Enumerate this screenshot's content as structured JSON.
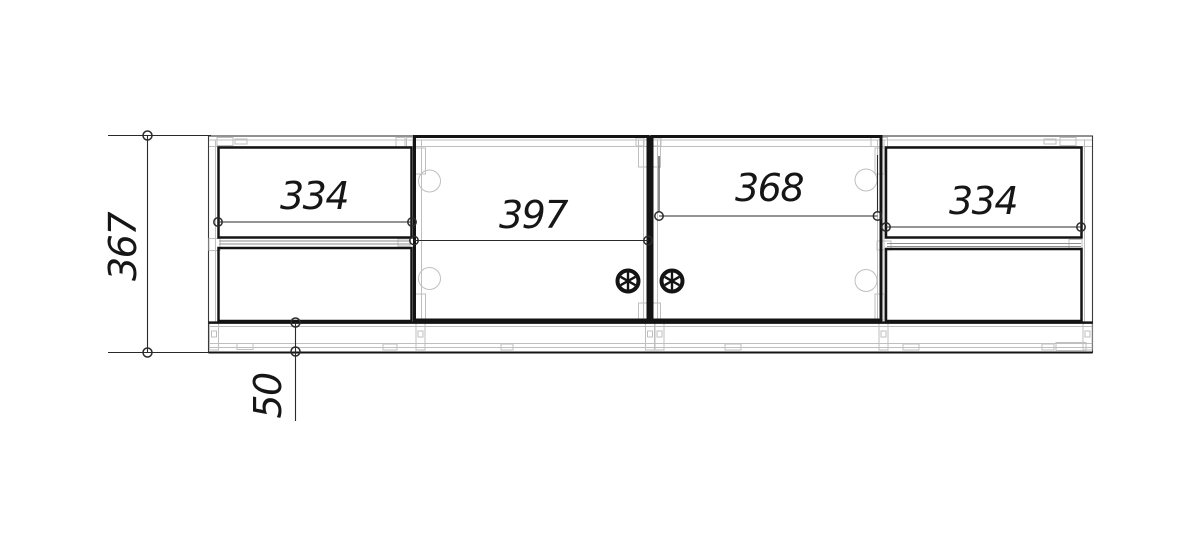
{
  "drawing": {
    "kind": "furniture-front-elevation",
    "dims": {
      "overall_height": "367",
      "plinth_height": "50",
      "left_drawers_width": "334",
      "left_door_width": "397",
      "right_door_width": "368",
      "right_drawers_width": "334"
    },
    "colors": {
      "line": "#141414",
      "light_gray": "#bfbfbf",
      "background": "#ffffff"
    }
  }
}
